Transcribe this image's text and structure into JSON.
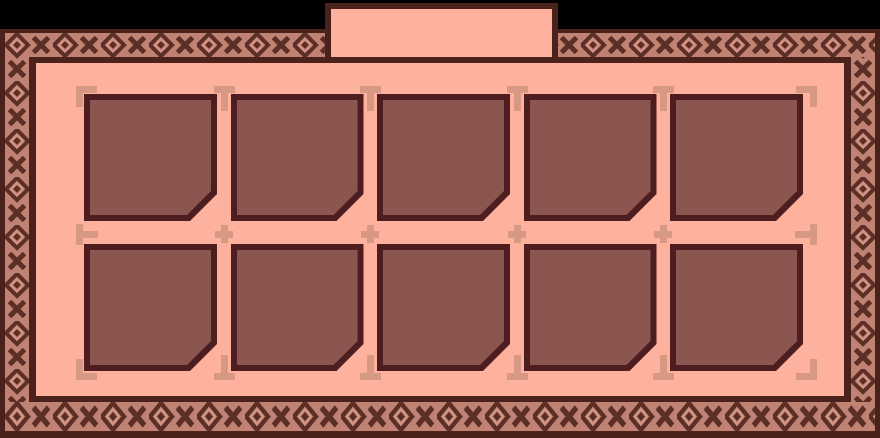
{
  "screen": {
    "name": "inventory-panel",
    "title": ""
  },
  "tab": {
    "label": ""
  },
  "inventory": {
    "rows": 2,
    "columns": 5,
    "slot_count": 10,
    "slots": [
      {
        "id": 1,
        "state": "empty",
        "item": null
      },
      {
        "id": 2,
        "state": "empty",
        "item": null
      },
      {
        "id": 3,
        "state": "empty",
        "item": null
      },
      {
        "id": 4,
        "state": "empty",
        "item": null
      },
      {
        "id": 5,
        "state": "empty",
        "item": null
      },
      {
        "id": 6,
        "state": "empty",
        "item": null
      },
      {
        "id": 7,
        "state": "empty",
        "item": null
      },
      {
        "id": 8,
        "state": "empty",
        "item": null
      },
      {
        "id": 9,
        "state": "empty",
        "item": null
      },
      {
        "id": 10,
        "state": "empty",
        "item": null
      }
    ]
  },
  "colors": {
    "background": "#000000",
    "frame_edge": "#4b221b",
    "pattern_base": "#c08273",
    "pattern_light": "#cf9180",
    "pattern_dark": "#5b2e26",
    "panel": "#feb29e",
    "slot_fill": "#8c5650",
    "slot_border": "#4d1d20",
    "guide": "#d79983"
  },
  "decorations": {
    "border_style": "diamond-x-weave",
    "guide_mark_types": [
      "corner-bracket",
      "tee",
      "plus"
    ]
  }
}
